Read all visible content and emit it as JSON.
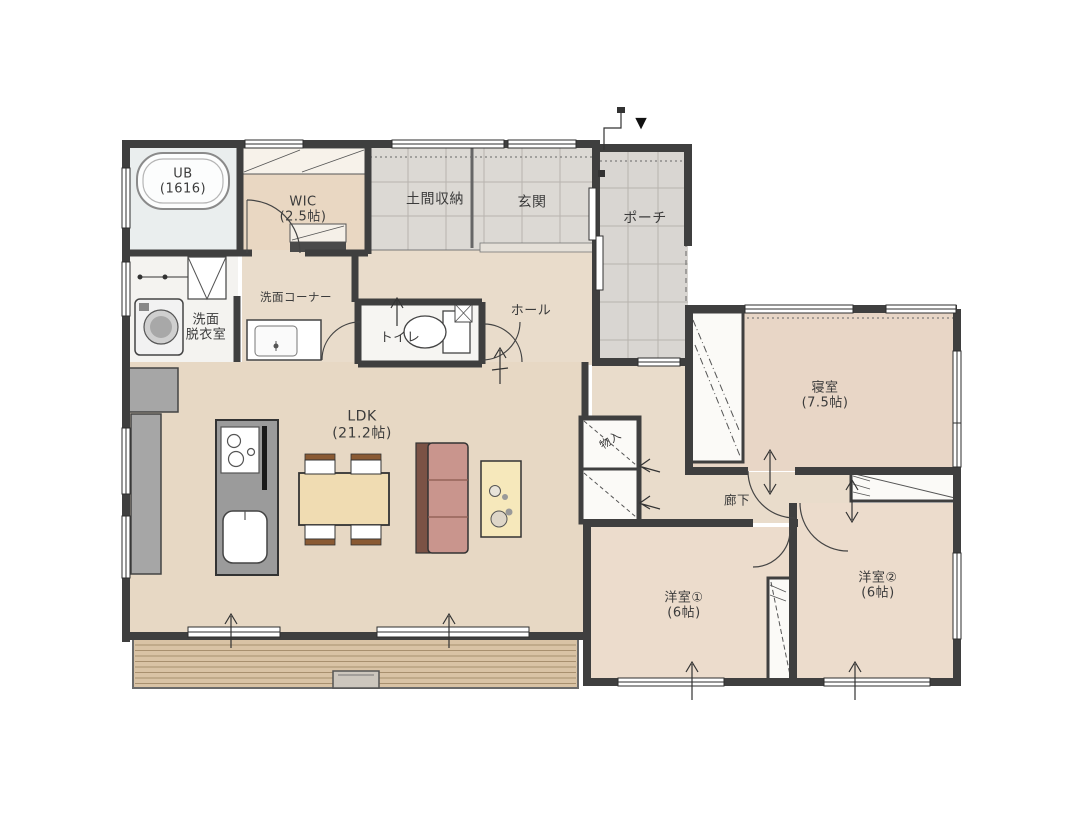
{
  "plan_title": "floor-plan",
  "markers": {
    "entrance": "▼"
  },
  "palette": {
    "wall": "#3f3f3f",
    "wood_floor": "#e8dbc8",
    "room_floor": "#ecdccc",
    "tile_floor": "#dcd9d4",
    "bath_floor": "#eaeeee",
    "deck_wood": "#d9c3a5",
    "kitchen_gray": "#9b9b9b",
    "sofa_pink": "#c9958d",
    "sofa_back_brown": "#7b5245",
    "table_wood": "#f0dcb2",
    "side_table_yellow": "#f6e8bb",
    "closet_white": "#fbfaf7"
  },
  "rooms": {
    "ub": {
      "line1": "UB",
      "line2": "(1616)"
    },
    "wic": {
      "line1": "WIC",
      "line2": "(2.5帖)"
    },
    "doma": {
      "line1": "土間収納",
      "line2": ""
    },
    "genkan": {
      "line1": "玄関",
      "line2": ""
    },
    "porch": {
      "line1": "ポーチ",
      "line2": ""
    },
    "senmen_datsui": {
      "line1": "洗面",
      "line2": "脱衣室"
    },
    "senmen_corner": {
      "line1": "洗面コーナー",
      "line2": ""
    },
    "toilet": {
      "line1": "トイレ",
      "line2": ""
    },
    "hall": {
      "line1": "ホール",
      "line2": ""
    },
    "ldk": {
      "line1": "LDK",
      "line2": "(21.2帖)"
    },
    "monoire": {
      "line1": "物入",
      "line2": ""
    },
    "rouka": {
      "line1": "廊下",
      "line2": ""
    },
    "shinshitsu": {
      "line1": "寝室",
      "line2": "(7.5帖)"
    },
    "yoshitsu1": {
      "line1": "洋室①",
      "line2": "(6帖)"
    },
    "yoshitsu2": {
      "line1": "洋室②",
      "line2": "(6帖)"
    }
  }
}
